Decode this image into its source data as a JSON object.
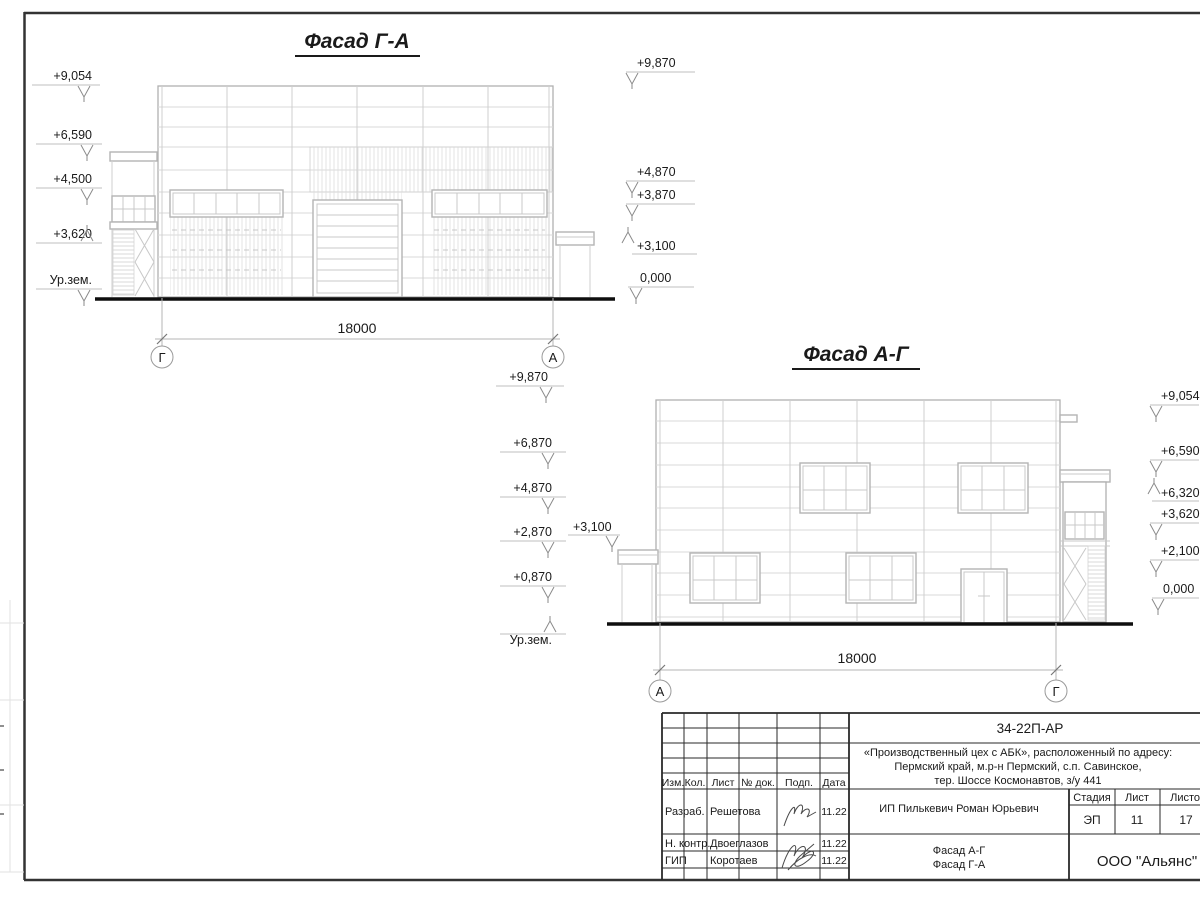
{
  "facade_ga": {
    "title": "Фасад Г-А",
    "marks_left": [
      "+9,054",
      "+6,590",
      "+4,500",
      "+3,620",
      "Ур.зем."
    ],
    "marks_right": [
      "+9,870",
      "+4,870",
      "+3,870",
      "+3,100",
      "0,000"
    ],
    "dimension": "18000",
    "axis_left": "Г",
    "axis_right": "А"
  },
  "facade_ag": {
    "title": "Фасад А-Г",
    "marks_left": [
      "+9,870",
      "+6,870",
      "+4,870",
      "+2,870",
      "+0,870",
      "Ур.зем."
    ],
    "mark_canopy": "+3,100",
    "marks_right": [
      "+9,054",
      "+6,590",
      "+6,320",
      "+3,620",
      "+2,100",
      "0,000"
    ],
    "dimension": "18000",
    "axis_left": "А",
    "axis_right": "Г"
  },
  "titleblock": {
    "doc_code": "34-22П-АР",
    "project_address_line1": "«Производственный цех с АБК», расположенный по адресу:",
    "project_address_line2": "Пермский край, м.р-н Пермский, с.п. Савинское,",
    "project_address_line3": "тер. Шоссе Космонавтов, з/у 441",
    "client": "ИП Пилькевич Роман Юрьевич",
    "columns": [
      "Изм.",
      "Кол.",
      "Лист",
      "№ док.",
      "Подп.",
      "Дата"
    ],
    "stage_label": "Стадия",
    "sheet_label": "Лист",
    "sheets_label": "Листов",
    "stage": "ЭП",
    "sheet_no": "11",
    "sheets_total": "17",
    "rows": [
      {
        "role": "Разраб.",
        "name": "Решетова",
        "date": "11.22"
      },
      {
        "role": "Н. контр.",
        "name": "Двоеглазов",
        "date": "11.22"
      },
      {
        "role": "ГИП",
        "name": "Коротаев",
        "date": "11.22"
      }
    ],
    "sheet_title_line1": "Фасад А-Г",
    "sheet_title_line2": "Фасад Г-А",
    "organization": "ООО \"Альянс\""
  }
}
